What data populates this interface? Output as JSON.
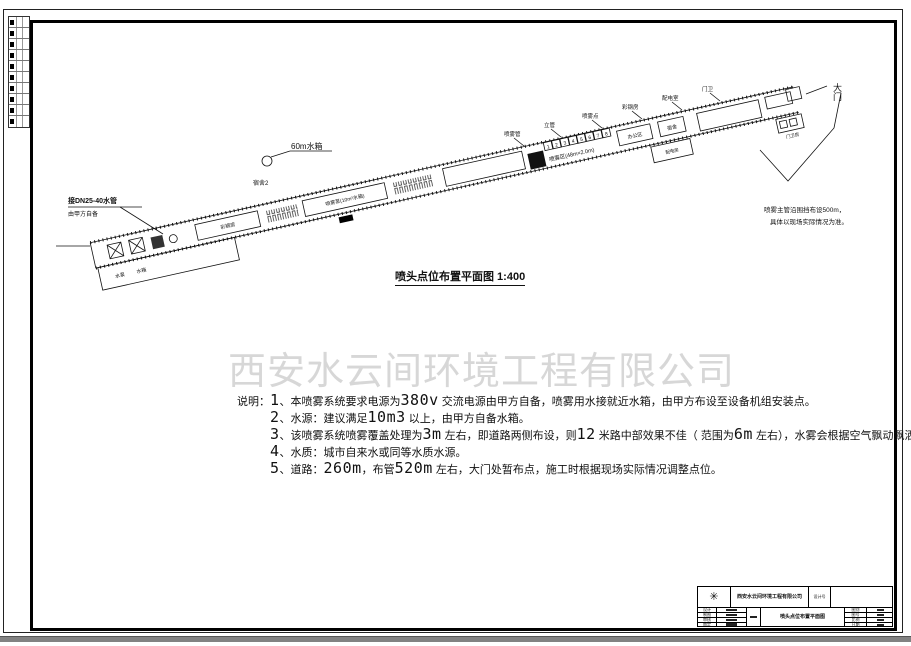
{
  "watermark": "西安水云间环境工程有限公司",
  "plan": {
    "title": "喷头点位布置平面图 1:400",
    "gate": "大门",
    "water_tank_label": "60m水箱",
    "dorm_label": "宿舍2",
    "inlet_note": {
      "line1": "接DN25-40水管",
      "line2": "由甲方自备"
    },
    "side_note": {
      "line1": "喷雾主管沿围挡布设500m，",
      "line2": "具体以现场实际情况为准。"
    },
    "leader_labels": [
      "喷雾管",
      "立管",
      "喷雾点",
      "彩钢房",
      "配电室",
      "门卫"
    ],
    "room_labels": {
      "left1": "水泵",
      "left2": "水箱",
      "r1": "彩钢房",
      "r2": "喷雾泵(10m³水箱)",
      "spray_zone": "喷雾区(48m×2.0m)",
      "r3": "办公区",
      "r4": "宿舍",
      "b1": "配电房",
      "b2": "门卫房"
    },
    "numbers": [
      "1",
      "2",
      "3",
      "4",
      "5",
      "6",
      "7",
      "8"
    ]
  },
  "notes": {
    "prefix": "说明：",
    "lines": [
      [
        "1",
        "、本喷雾系统要求电源为",
        "380v",
        " 交流电源由甲方自备，喷雾用水接就近水箱，由甲方布设至设备机组安装点。"
      ],
      [
        "2",
        "、水源：建议满足",
        "10m3",
        " 以上，由甲方自备水箱。"
      ],
      [
        "3",
        "、该喷雾系统喷雾覆盖处理为",
        "3m",
        " 左右，即道路两侧布设，则",
        "12",
        " 米路中部效果不佳（  范围为",
        "6m",
        " 左右），水雾会根据空气飘动飘洒。"
      ],
      [
        "4",
        "、水质：城市自来水或同等水质水源。"
      ],
      [
        "5",
        "、道路：",
        "260m",
        "，布管",
        "520m",
        " 左右，大门处暂布点，施工时根据现场实际情况调整点位。"
      ]
    ]
  },
  "titleblock": {
    "logo": "✳",
    "company": "西安水云间环境工程有限公司",
    "design_no_label": "设计号",
    "drawing_name": "喷头点位布置平面图",
    "left_rows": [
      "设计",
      "制图",
      "审核",
      "审定"
    ],
    "right_rows": [
      "图别",
      "图号",
      "比例",
      "日期"
    ]
  }
}
